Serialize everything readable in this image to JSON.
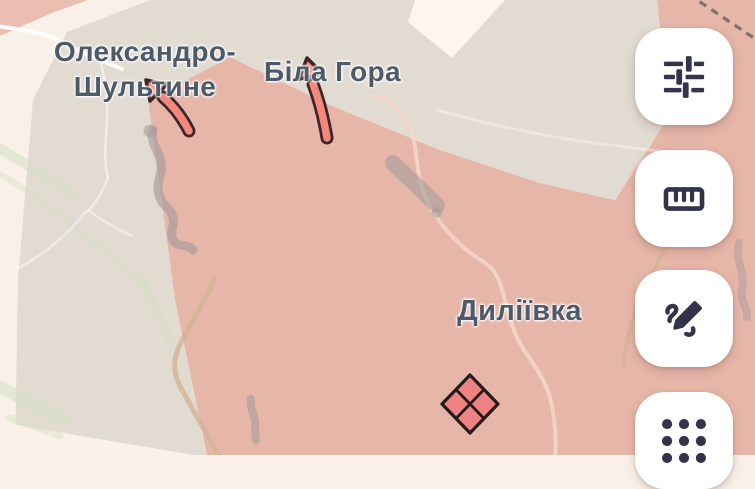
{
  "map": {
    "labels": [
      {
        "id": "oleksandro-shultyne",
        "text": "Олександро-\nШультине"
      },
      {
        "id": "bila-hora",
        "text": "Біла Гора"
      },
      {
        "id": "dyliivka",
        "text": "Диліївка"
      }
    ],
    "markers": [
      {
        "type": "advance-arrow",
        "near": "Олександро-Шультине",
        "direction": "northwest"
      },
      {
        "type": "advance-arrow",
        "near": "Біла Гора",
        "direction": "north"
      },
      {
        "type": "unit-symbol-quartered-diamond",
        "near": "Диліївка"
      }
    ],
    "colors": {
      "base": "#f9f1e8",
      "zone_buffer": "#e2dbd2",
      "zone_occupied": "#e6b6a9",
      "arrow_fill": "#f5877c",
      "arrow_outline": "#3c2628",
      "symbol_fill": "#ef8383",
      "symbol_outline": "#241b18",
      "label_text": "#4d5a69"
    }
  },
  "toolbar": {
    "buttons": [
      {
        "id": "adjustments",
        "icon": "tune-sliders-icon"
      },
      {
        "id": "measure",
        "icon": "ruler-icon"
      },
      {
        "id": "draw",
        "icon": "draw-scribble-icon"
      },
      {
        "id": "apps",
        "icon": "dots-grid-icon"
      }
    ]
  }
}
